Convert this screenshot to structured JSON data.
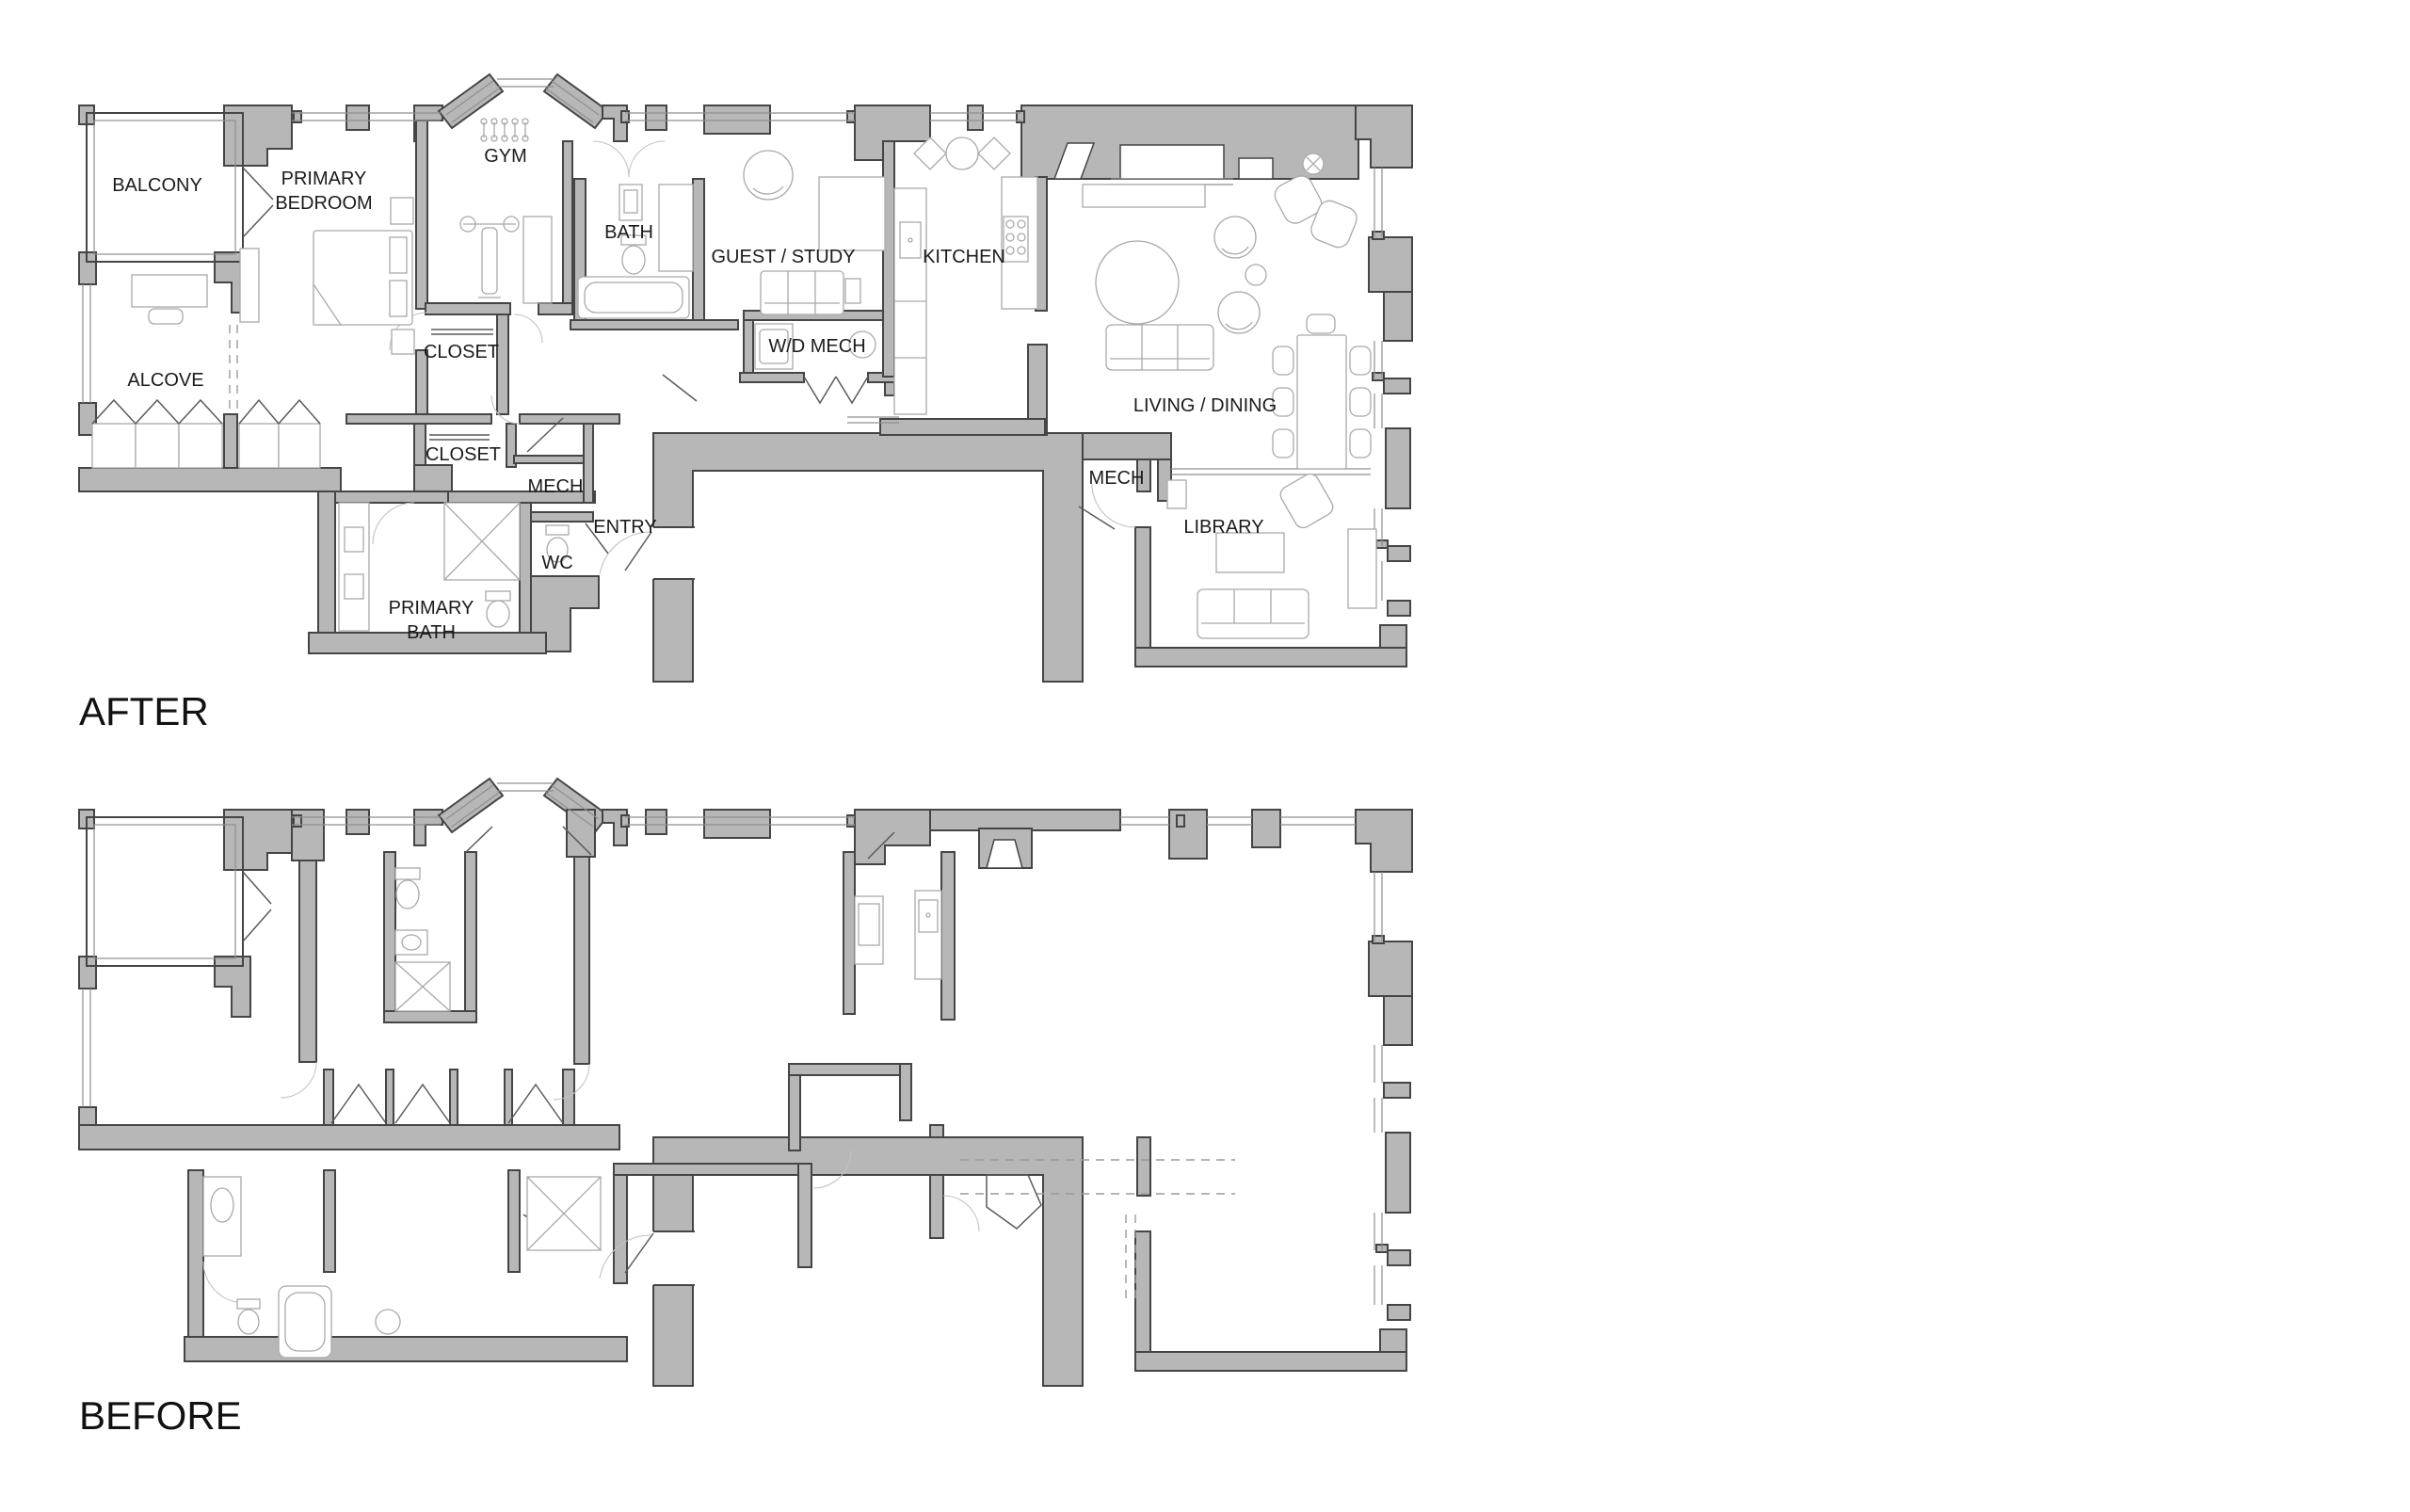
{
  "colors": {
    "background": "#ffffff",
    "wall_fill": "#b7b7b7",
    "wall_stroke": "#454545",
    "thin_line": "#8f8f8f",
    "furniture_line": "#a9a9a9",
    "dashed_line": "#9a9a9a",
    "label_text": "#1b1b1b"
  },
  "plans": {
    "after": {
      "title": "AFTER",
      "labels": {
        "balcony": "BALCONY",
        "primary_bedroom_line1": "PRIMARY",
        "primary_bedroom_line2": "BEDROOM",
        "gym": "GYM",
        "bath": "BATH",
        "guest_study": "GUEST / STUDY",
        "kitchen": "KITCHEN",
        "alcove": "ALCOVE",
        "closet_bedroom": "CLOSET",
        "wd_mech": "W/D MECH",
        "living_dining": "LIVING / DINING",
        "closet_entry": "CLOSET",
        "mech_entry": "MECH",
        "entry": "ENTRY",
        "wc": "WC",
        "primary_bath_line1": "PRIMARY",
        "primary_bath_line2": "BATH",
        "mech_library": "MECH",
        "library": "LIBRARY"
      },
      "icons": {
        "gym_equipment": "dumbbell-rack-icon",
        "shower": "shower-x-icon",
        "wardrobe_row": "hanging-clothes-icon"
      }
    },
    "before": {
      "title": "BEFORE",
      "labels": {}
    }
  }
}
